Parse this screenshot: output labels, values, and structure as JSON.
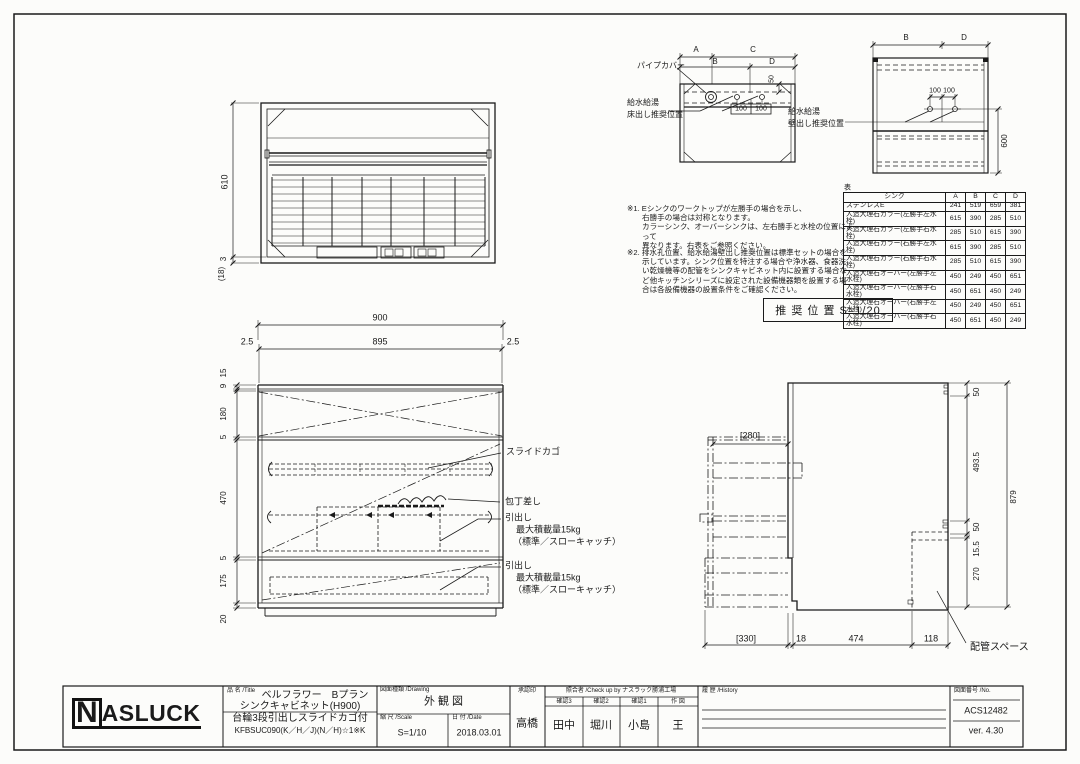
{
  "plan_view": {
    "dim_depth": "610",
    "dim_gap": "3",
    "dim_back": "(18)"
  },
  "detail_floor": {
    "dim_a": "A",
    "dim_b": "B",
    "dim_c": "C",
    "dim_d": "D",
    "dim_50": "50",
    "dim_100_1": "100",
    "dim_100_2": "100",
    "label_pipe_cover": "パイプカバー",
    "label_supply_1": "給水給湯",
    "label_supply_2": "床出し推奨位置"
  },
  "detail_wall": {
    "dim_b": "B",
    "dim_d": "D",
    "dim_100_1": "100",
    "dim_100_2": "100",
    "dim_600": "600",
    "label_supply_1": "給水給湯",
    "label_supply_2": "壁出し推奨位置"
  },
  "notes": {
    "note1": [
      "※1. Eシンクのワークトップが左勝手の場合を示し、",
      "右勝手の場合は対称となります。",
      "カラーシンク、オーバーシンクは、左右勝手と水栓の位置によって",
      "異なります。右表をご参照ください。"
    ],
    "note2": [
      "※2. 排水孔位置、給水給湯壁出し推奨位置は標準セットの場合を",
      "示しています。シンク位置を特注する場合や浄水器、食器洗",
      "い乾燥機等の配管をシンクキャビネット内に設置する場合な",
      "ど他キッチンシリーズに設定された設備機器類を設置する場",
      "合は各設備機器の設置条件をご確認ください。"
    ]
  },
  "sink_table": {
    "caption": "表",
    "headers": [
      "シンク",
      "A",
      "B",
      "C",
      "D"
    ],
    "rows": [
      {
        "name": "ステンレスE",
        "a": "241",
        "b": "519",
        "c": "659",
        "d": "381"
      },
      {
        "name": "人造大理石カラー(左勝手左水栓)",
        "a": "615",
        "b": "390",
        "c": "285",
        "d": "510"
      },
      {
        "name": "人造大理石カラー(左勝手右水栓)",
        "a": "285",
        "b": "510",
        "c": "615",
        "d": "390"
      },
      {
        "name": "人造大理石カラー(右勝手左水栓)",
        "a": "615",
        "b": "390",
        "c": "285",
        "d": "510"
      },
      {
        "name": "人造大理石カラー(右勝手右水栓)",
        "a": "285",
        "b": "510",
        "c": "615",
        "d": "390"
      },
      {
        "name": "人造大理石オーバー(左勝手左水栓)",
        "a": "450",
        "b": "249",
        "c": "450",
        "d": "651"
      },
      {
        "name": "人造大理石オーバー(左勝手右水栓)",
        "a": "450",
        "b": "651",
        "c": "450",
        "d": "249"
      },
      {
        "name": "人造大理石オーバー(右勝手左水栓)",
        "a": "450",
        "b": "249",
        "c": "450",
        "d": "651"
      },
      {
        "name": "人造大理石オーバー(右勝手右水栓)",
        "a": "450",
        "b": "651",
        "c": "450",
        "d": "249"
      }
    ]
  },
  "recommended": {
    "label": "推 奨 位 置  S=1/20"
  },
  "front_view": {
    "dim_900": "900",
    "dim_25l": "2.5",
    "dim_895": "895",
    "dim_25r": "2.5",
    "left_dims": [
      "15",
      "9",
      "180",
      "5",
      "470",
      "5",
      "175",
      "20"
    ],
    "label_slide": "スライドカゴ",
    "label_knife": "包丁差し",
    "drawer_note": {
      "l1": "引出し",
      "l2": "最大積載量15kg",
      "l3": "（標準／スローキャッチ）"
    }
  },
  "side_view": {
    "dim_280": "[280]",
    "right_dims": [
      "50",
      "493.5",
      "50",
      "15.5",
      "270"
    ],
    "dim_879": "879",
    "bottom_dims": [
      "[330]",
      "18",
      "474",
      "118"
    ],
    "label_piping": "配管スペース"
  },
  "title_block": {
    "logo_n": "N",
    "logo_rest": "ASLUCK",
    "title_label": "品 名 /Title",
    "title_line1": "ベルフラワー　Bプラン",
    "title_line2": "シンクキャビネット(H900)",
    "title_line3": "台輪3段引出しスライドカゴ付",
    "title_line4": "KFBSUC090(K／H／J)(N／H)☆1※K",
    "drawing_label": "図面種類 /Drawing",
    "drawing_type": "外観図",
    "scale_label": "縮 尺 /Scale",
    "scale_value": "S=1/10",
    "date_label": "日 付 /Date",
    "date_value": "2018.03.01",
    "approval_label": "承認印",
    "approval_name": "高橋",
    "checkup_label": "照合者 /Check up by ナスラック勝浦工場",
    "check_cols": [
      {
        "label": "確認3",
        "name": "田中"
      },
      {
        "label": "確認2",
        "name": "堀川"
      },
      {
        "label": "確認1",
        "name": "小島"
      },
      {
        "label": "作 図",
        "name": "王"
      }
    ],
    "history_label": "履 歴 /History",
    "number_label": "図面番号 /No.",
    "number_value": "ACS12482",
    "version": "ver. 4.30"
  }
}
